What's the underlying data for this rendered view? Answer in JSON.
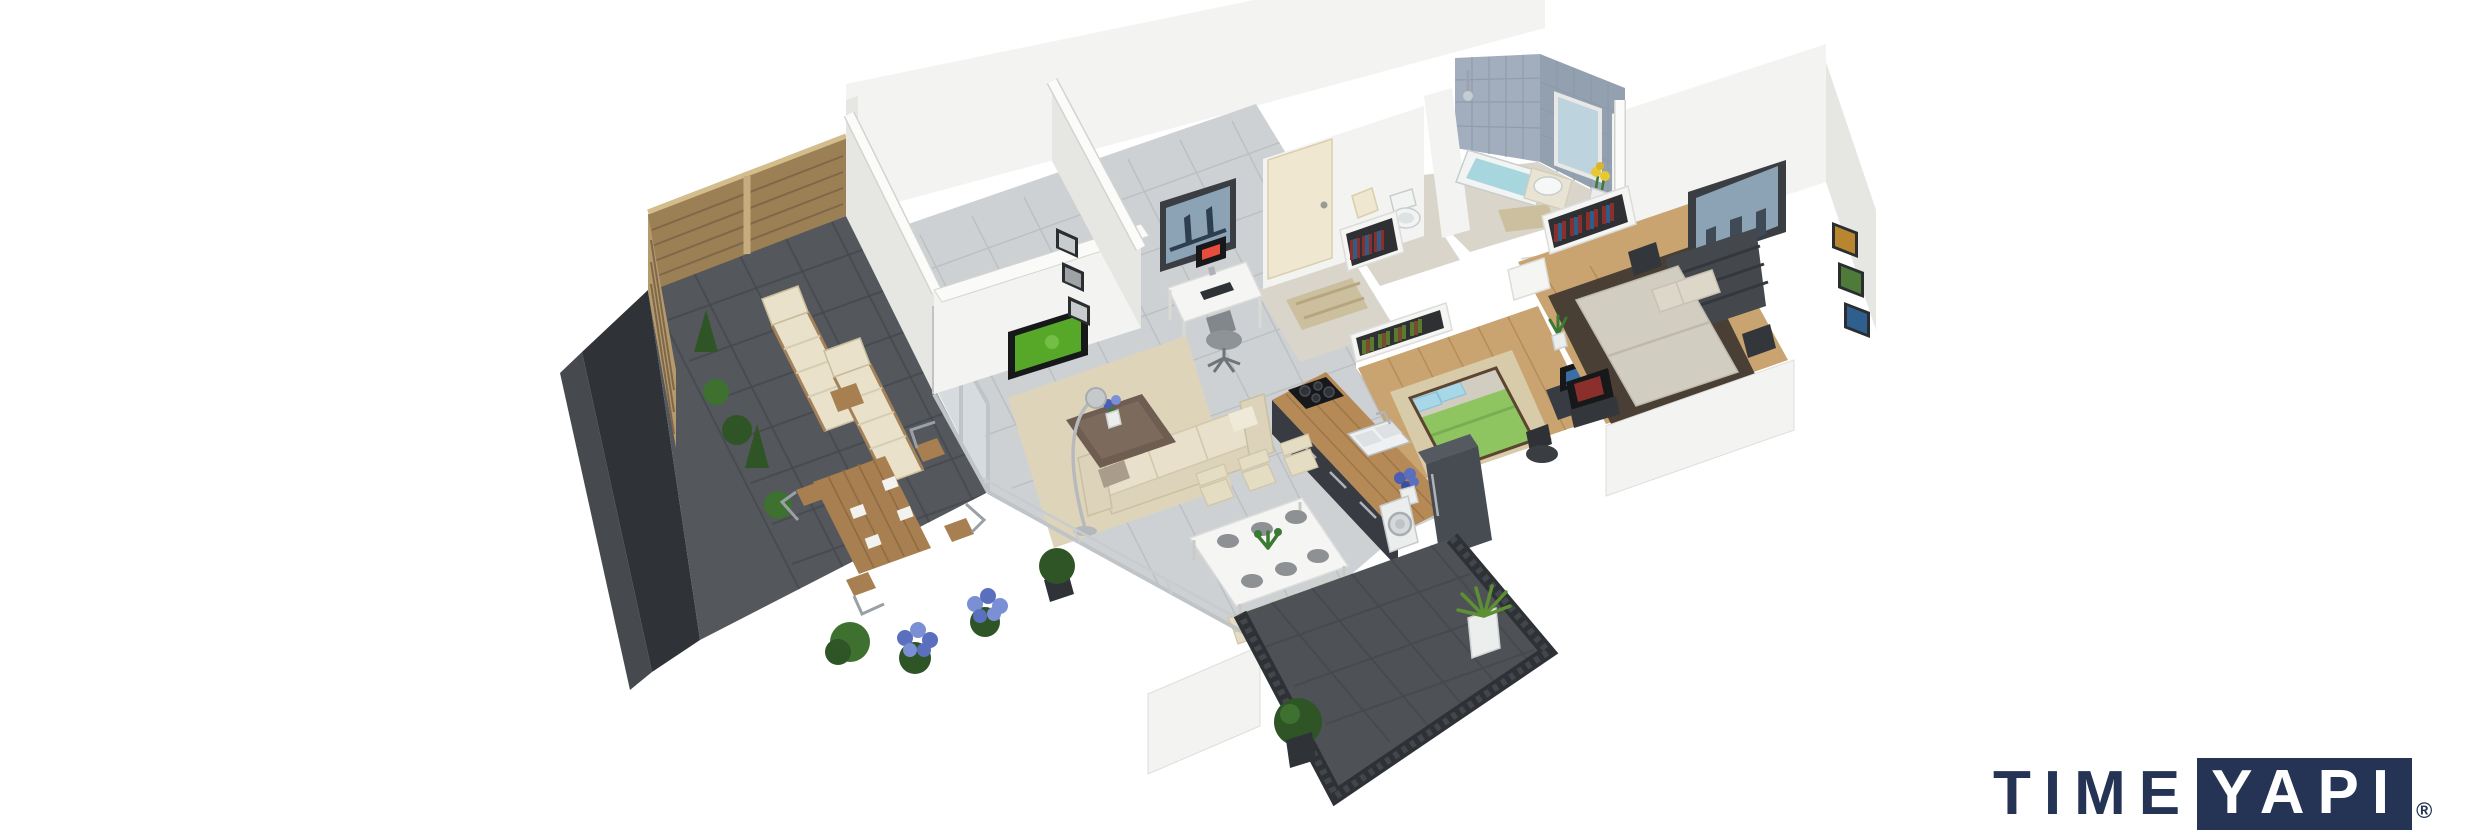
{
  "logo": {
    "time": "TIME",
    "yapi": "YAPI",
    "registered": "®",
    "navy": "#253455"
  },
  "scene": {
    "type": "isometric-3d-floor-plan-render",
    "rooms": [
      "terrace",
      "living-room",
      "dining-area",
      "kitchen",
      "second-bedroom",
      "master-bedroom",
      "hallway",
      "wc",
      "bathroom",
      "balcony"
    ],
    "palette": {
      "background": "#ffffff",
      "wall": "#f3f3f1",
      "wall_shadow": "#e6e6e3",
      "terrace_tile": "#54575b",
      "dark_edging": "#2f3236",
      "fence_wood": "#9b7f55",
      "shrub_green": "#2f5526",
      "hydrangea_blue": "#5a6fbe",
      "lounger_cushion": "#e9e1ca",
      "interior_tile": "#ced1d4",
      "area_rug": "#ded4b9",
      "sofa_cream": "#e8e0ca",
      "coffee_table_brown": "#6e5d50",
      "tv_screen_green": "#57a829",
      "kitchen_counter_wood": "#b58a57",
      "kitchen_cabinet": "#383c42",
      "fridge_gray": "#474b52",
      "bed2_duvet_green": "#8ec561",
      "bed2_pillow_blue": "#a8d8e8",
      "bedroom_wood_floor": "#c9a470",
      "bath_tile_blue": "#a2aebd",
      "bath_water": "#a7d6de",
      "master_mattress": "#d2cdc1",
      "master_rug_brown": "#4a3f34",
      "balcony_floor": "#4e5156",
      "railing_dark": "#2e3237",
      "logo_navy": "#253455"
    }
  }
}
